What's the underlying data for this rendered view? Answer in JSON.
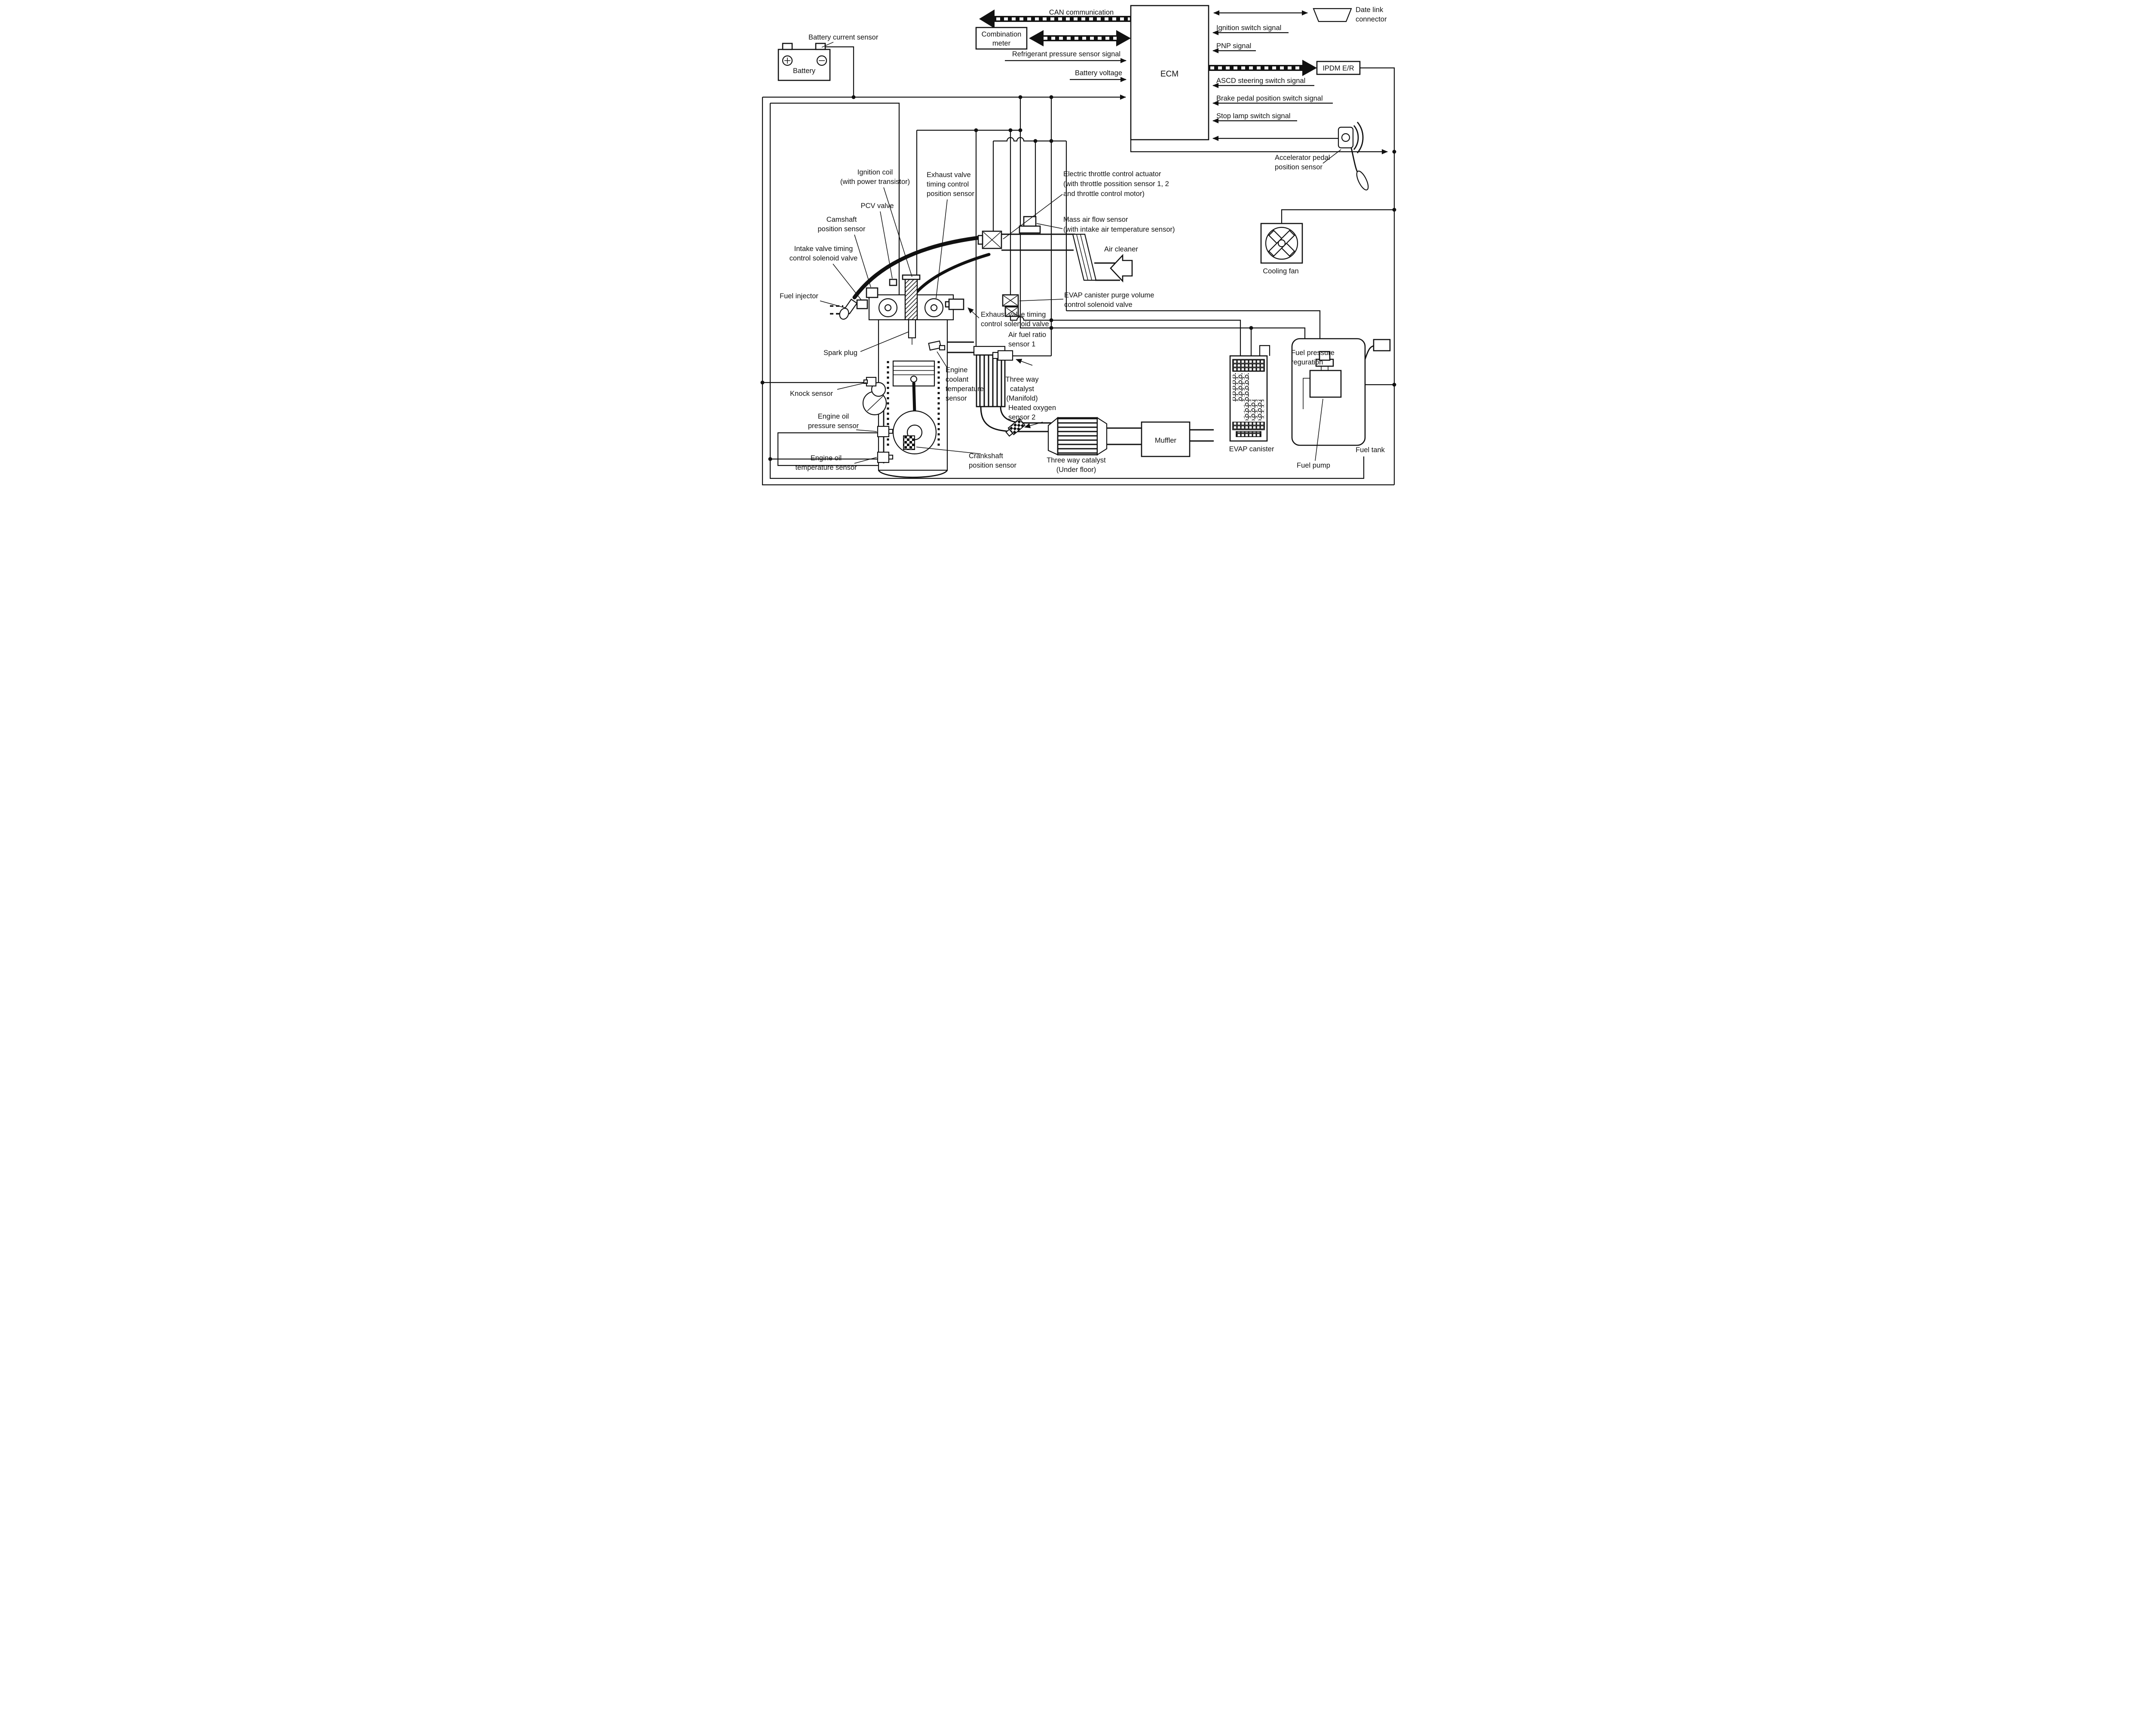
{
  "colors": {
    "ink": "#111111",
    "background": "#ffffff"
  },
  "labels": {
    "battery_current_sensor": "Battery current sensor",
    "battery": "Battery",
    "can_communication": "CAN communication",
    "combination_meter_1": "Combination",
    "combination_meter_2": "meter",
    "refrigerant_signal": "Refrigerant pressure sensor signal",
    "battery_voltage": "Battery voltage",
    "ecm": "ECM",
    "date_link_1": "Date link",
    "date_link_2": "connector",
    "ignition_switch_signal": "Ignition switch signal",
    "pnp_signal": "PNP signal",
    "ipdm": "IPDM E/R",
    "ascd_signal": "ASCD steering switch signal",
    "brake_signal": "Brake pedal position switch signal",
    "stop_lamp_signal": "Stop lamp switch signal",
    "accelerator_1": "Accelerator pedal",
    "accelerator_2": "position sensor",
    "ignition_coil_1": "Ignition coil",
    "ignition_coil_2": "(with power transistor)",
    "exh_pos_1": "Exhaust valve",
    "exh_pos_2": "timing control",
    "exh_pos_3": "position sensor",
    "pcv_valve": "PCV valve",
    "camshaft_1": "Camshaft",
    "camshaft_2": "position sensor",
    "intake_valve_1": "Intake valve timing",
    "intake_valve_2": "control solenoid valve",
    "fuel_injector": "Fuel injector",
    "throttle_1": "Electric throttle control actuator",
    "throttle_2": "(with throttle possition sensor 1, 2",
    "throttle_3": " and throttle control motor)",
    "maf_1": "Mass air flow sensor",
    "maf_2": "(with intake air temperature sensor)",
    "air_cleaner": "Air cleaner",
    "evap_purge_1": "EVAP canister purge volume",
    "evap_purge_2": "control solenoid valve",
    "exh_sol_1": "Exhaust valve timing",
    "exh_sol_2": "control solenoid valve",
    "afr_1": "Air fuel ratio",
    "afr_2": "sensor 1",
    "spark_plug": "Spark plug",
    "coolant_1": "Engine",
    "coolant_2": "coolant",
    "coolant_3": "temperature",
    "coolant_4": "sensor",
    "twc_m_1": "Three way",
    "twc_m_2": "catalyst",
    "twc_m_3": "(Manifold)",
    "ho2_1": "Heated oxygen",
    "ho2_2": "sensor 2",
    "knock_sensor": "Knock sensor",
    "oil_p_1": "Engine oil",
    "oil_p_2": "pressure sensor",
    "oil_t_1": "Engine oil",
    "oil_t_2": "temperature sensor",
    "crank_1": "Crankshaft",
    "crank_2": "position sensor",
    "twc_u_1": "Three way catalyst",
    "twc_u_2": "(Under floor)",
    "muffler": "Muffler",
    "cooling_fan": "Cooling fan",
    "evap_canister": "EVAP canister",
    "fp_reg_1": "Fuel pressure",
    "fp_reg_2": "reguration",
    "fuel_pump": "Fuel pump",
    "fuel_tank": "Fuel tank"
  }
}
